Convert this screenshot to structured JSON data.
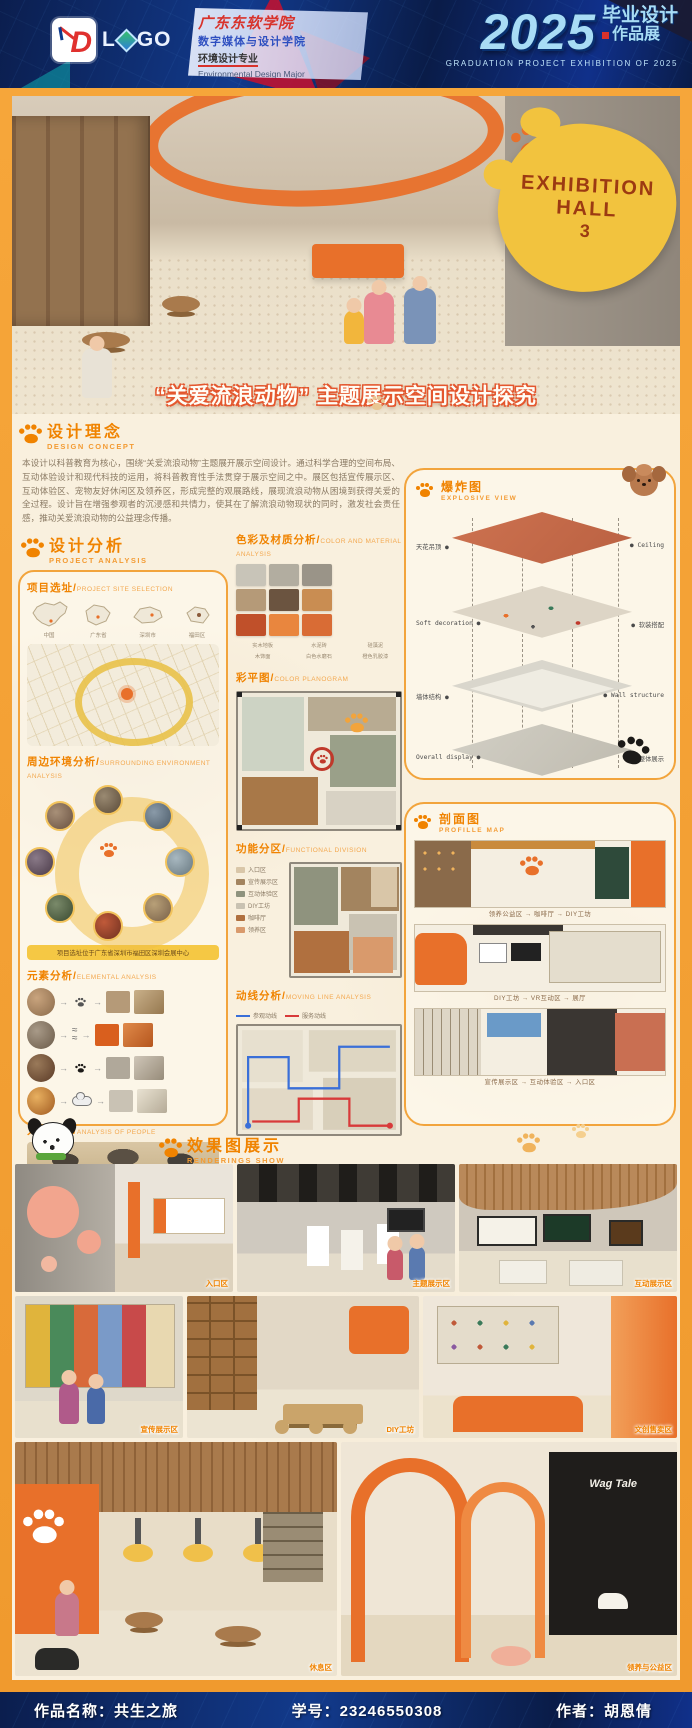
{
  "header": {
    "logo_letter": "D",
    "logo_text_l": "L",
    "logo_text_r": "GO",
    "school": "广东东软学院",
    "college": "数字媒体与设计学院",
    "major": "环境设计专业",
    "major_en": "Environmental Design Major",
    "year": "2025",
    "exhibit_cn_top": "毕业设计",
    "exhibit_cn_bottom": "作品展",
    "exhibit_en": "GRADUATION PROJECT EXHIBITION OF 2025"
  },
  "hero": {
    "sign_line1": "EXHIBITION",
    "sign_line2": "HALL",
    "sign_line3": "3",
    "title": "“关爱流浪动物” 主题展示空间设计探究"
  },
  "concept": {
    "cn": "设计理念",
    "en": "DESIGN CONCEPT",
    "body": "本设计以科普教育为核心，围绕“关爱流浪动物”主题展开展示空间设计。通过科学合理的空间布局、互动体验设计和现代科技的运用，将科普教育性手法贯穿于展示空间之中。展区包括宣传展示区、互动体验区、宠物友好休闲区及领养区，形成完整的观展路线，展现流浪动物从困境到获得关爱的全过程。设计旨在增强参观者的沉浸感和共情力，使其在了解流浪动物现状的同时，激发社会责任感，推动关爱流浪动物的公益理念传播。"
  },
  "analysis": {
    "cn": "设计分析",
    "en": "PROJECT ANALYSIS",
    "site": {
      "cn": "项目选址",
      "en": "PROJECT SITE SELECTION",
      "maps": [
        "中国",
        "广东省",
        "深圳市",
        "福田区"
      ]
    },
    "surrounding": {
      "cn": "周边环境分析",
      "en": "SURROUNDING ENVIRONMENT ANALYSIS",
      "note": "项目选址位于广东省深圳市福田区深圳会展中心"
    },
    "elements": {
      "cn": "元素分析",
      "en": "ELEMENTAL ANALYSIS"
    },
    "people": {
      "cn": "人群分析",
      "en": "ANALYSIS OF PEOPLE",
      "bars": {
        "categories": [
          "老年群体",
          "儿童",
          "青年",
          "亲子家庭"
        ],
        "values": [
          55,
          75,
          65,
          92
        ]
      }
    },
    "colors": {
      "cn": "色彩及材质分析",
      "en": "COLOR AND MATERIAL ANALYSIS",
      "chips": [
        "#c8c4b8",
        "#b2ada0",
        "#9a9488",
        "#b59a78",
        "#6b5440",
        "#c98d52",
        "#c0502a",
        "#e9863e",
        "#d96c35"
      ],
      "materials": [
        {
          "label": "实木地板",
          "color": "#c77f3e"
        },
        {
          "label": "水泥砖",
          "color": "#b9b7b0"
        },
        {
          "label": "硅藻泥",
          "color": "#a9a7a0"
        },
        {
          "label": "木饰面",
          "color": "#6b5847"
        },
        {
          "label": "白色水磨石",
          "color": "#eae6dc"
        },
        {
          "label": "橙色乳胶漆",
          "color": "#d95f1e"
        }
      ]
    },
    "plan": {
      "cn": "彩平图",
      "en": "COLOR PLANOGRAM"
    },
    "function": {
      "cn": "功能分区",
      "en": "FUNCTIONAL DIVISION",
      "legend": [
        {
          "label": "入口区",
          "color": "#d9c6a8"
        },
        {
          "label": "宣传展示区",
          "color": "#a3845f"
        },
        {
          "label": "互动体验区",
          "color": "#8f937e"
        },
        {
          "label": "DIY工坊",
          "color": "#c9c2b2"
        },
        {
          "label": "咖啡厅",
          "color": "#b0703f"
        },
        {
          "label": "领养区",
          "color": "#d99a6c"
        }
      ]
    },
    "circulation": {
      "cn": "动线分析",
      "en": "MOVING LINE ANALYSIS",
      "legend": [
        {
          "label": "参观动线",
          "color": "#3a6fd8"
        },
        {
          "label": "服务动线",
          "color": "#d83a3a"
        }
      ]
    }
  },
  "explosive": {
    "cn": "爆炸图",
    "en": "EXPLOSIVE VIEW",
    "layers": [
      {
        "left": "天花吊顶",
        "right": "Ceiling"
      },
      {
        "left": "Soft decoration",
        "right": "软装搭配"
      },
      {
        "left": "墙体结构",
        "right": "Wall structure"
      },
      {
        "left": "Overall display",
        "right": "整体展示"
      }
    ]
  },
  "profile": {
    "cn": "剖面图",
    "en": "PROFILLE MAP",
    "rows": [
      {
        "zones": "领养公益区 → 咖啡厅 → DIY工坊"
      },
      {
        "zones": "DIY工坊 → VR互动区 → 展厅"
      },
      {
        "zones": "宣传展示区 → 互动体验区 → 入口区"
      }
    ]
  },
  "renderings": {
    "cn": "效果图展示",
    "en": "RENDERINGS SHOW",
    "items": [
      {
        "caption": "入口区"
      },
      {
        "caption": "主题展示区"
      },
      {
        "caption": "互动展示区"
      },
      {
        "caption": "宣传展示区"
      },
      {
        "caption": "DIY工坊"
      },
      {
        "caption": "文创售卖区"
      },
      {
        "caption": "休息区"
      },
      {
        "caption": "领养与公益区"
      }
    ],
    "storefront_sign": "Wag Tale"
  },
  "footer": {
    "work_label": "作品名称：",
    "work_name": "共生之旅",
    "id_label": "学号：",
    "id_value": "23246550308",
    "author_label": "作者：",
    "author_name": "胡恩倩"
  },
  "colors": {
    "accent_orange": "#f08300",
    "frame_orange": "#f4a033",
    "navy": "#0c2a66",
    "terracotta": "#c96f52"
  }
}
